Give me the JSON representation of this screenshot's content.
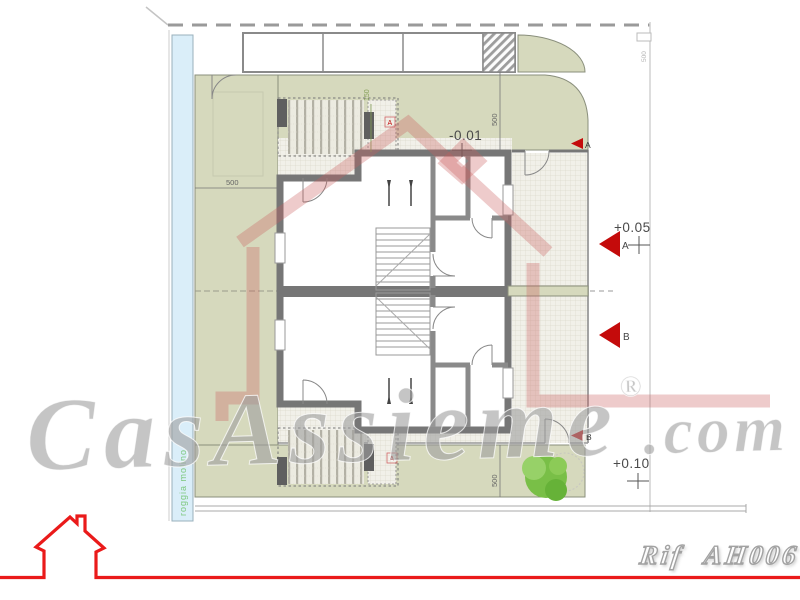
{
  "watermarks": {
    "brand_script": "CasAssieme",
    "registered_mark": "®",
    "domain_suffix": ".com",
    "reference_code": "Rif AH006"
  },
  "annotations": {
    "level_minus": "-0.01",
    "level_plus_a": "+0.05",
    "level_plus_b": "+0.10",
    "section_a": "A",
    "section_b": "B",
    "ramp_marker": "A"
  },
  "dimensions": {
    "dim_500_left": "500",
    "dim_500_top_right": "500",
    "dim_500_bottom": "500",
    "dim_500_edge": "500",
    "dim_150_ramp": "150"
  },
  "labels": {
    "canal_vertical_text": "roggia molino"
  },
  "colors": {
    "accent_red": "#ea1a1a",
    "marker_red": "#c40b0b",
    "watermark_pink": "#cb5c5c",
    "plan_green": "#d6d9bd",
    "water_blue": "#daeef9",
    "wall_gray": "#767676"
  }
}
